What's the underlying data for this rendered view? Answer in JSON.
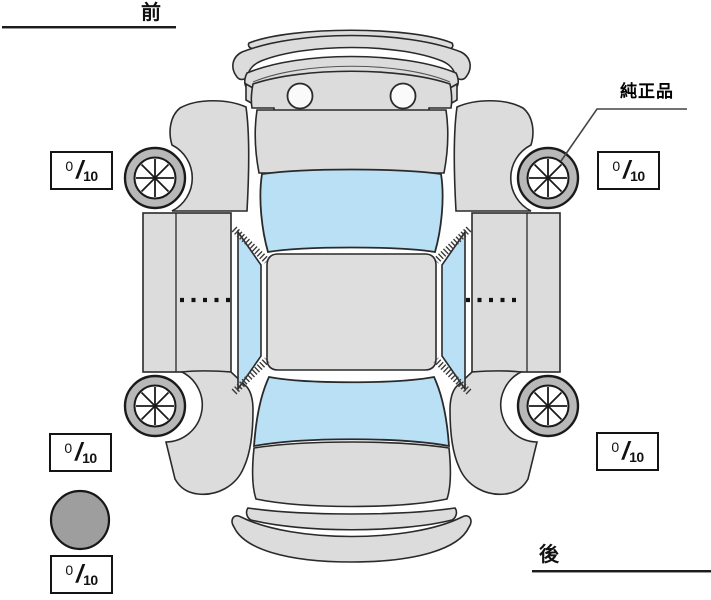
{
  "diagram": {
    "front_label": "前",
    "rear_label": "後",
    "genuine_part_label": "純正品"
  },
  "tread": {
    "separator": "/",
    "front_left": {
      "value": "0",
      "max": "10"
    },
    "front_right": {
      "value": "0",
      "max": "10"
    },
    "rear_left": {
      "value": "0",
      "max": "10"
    },
    "rear_right": {
      "value": "0",
      "max": "10"
    },
    "spare": {
      "value": "0",
      "max": "10"
    }
  },
  "colors": {
    "body": "#dcdcdc",
    "glass": "#b9e0f5",
    "tire_ring": "#b8b8b8",
    "spare_tire": "#9e9e9e",
    "outline": "#222222",
    "background": "#ffffff"
  }
}
